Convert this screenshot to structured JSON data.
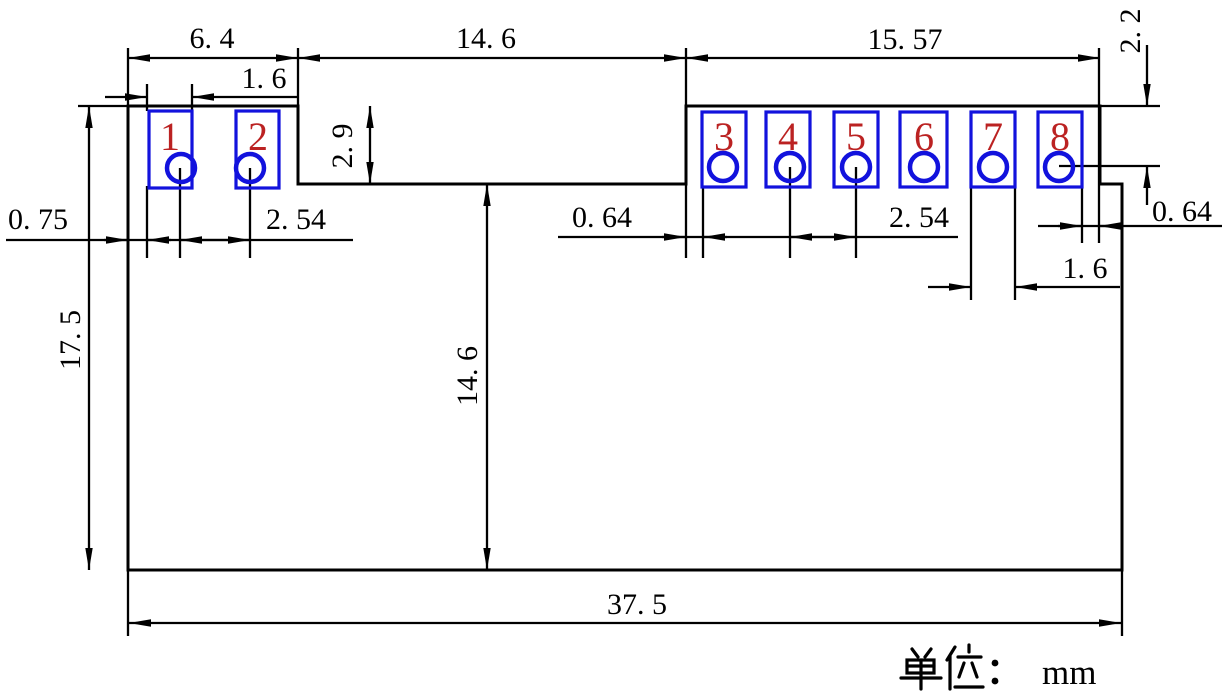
{
  "drawing": {
    "title_hint": "dimensioned footprint drawing of an 8-pad module",
    "colors": {
      "pad_outline": "#1212dd",
      "pin_number": "#bb2222",
      "line": "#000000"
    },
    "pins": [
      {
        "label": "1"
      },
      {
        "label": "2"
      },
      {
        "label": "3"
      },
      {
        "label": "4"
      },
      {
        "label": "5"
      },
      {
        "label": "6"
      },
      {
        "label": "7"
      },
      {
        "label": "8"
      }
    ],
    "dims": {
      "left_span": "6. 4",
      "pad_width_left": "1. 6",
      "notch_span": "14. 6",
      "right_span": "15. 57",
      "hole_top_offset": "2. 2",
      "edge_clearance_left": "0. 75",
      "pitch_left": "2. 54",
      "notch_depth": "2. 9",
      "notch_clearance": "0. 64",
      "pitch_right": "2. 54",
      "edge_clearance_right": "0. 64",
      "pad_width_right": "1. 6",
      "body_height": "17. 5",
      "notch_bottom_height": "14. 6",
      "body_width": "37. 5"
    },
    "footer": {
      "unit_label": "单位：",
      "unit_value": "mm"
    }
  }
}
